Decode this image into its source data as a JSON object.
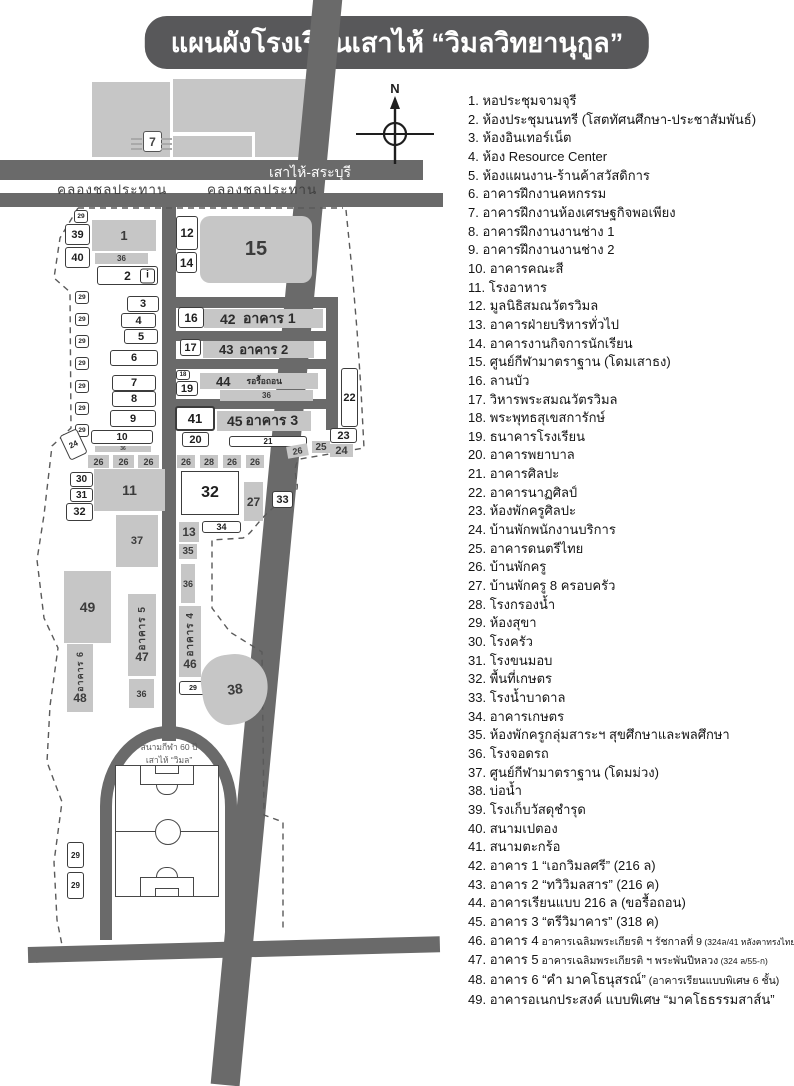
{
  "title": "แผนผังโรงเรียนเสาไห้ “วิมลวิทยานุกูล”",
  "compass": {
    "north_label": "N"
  },
  "roads": {
    "main_road": "เสาไห้-สระบุรี",
    "canal_left": "คลองชลประทาน",
    "canal_right": "คลองชลประทาน"
  },
  "stadium": {
    "line1": "สนามกีฬา 60 ปี",
    "line2": "เสาไห้ “วิมล”"
  },
  "icons": {
    "seven_store": "7",
    "info": "i"
  },
  "map_labels": {
    "n1": "1",
    "n2": "2",
    "n3": "3",
    "n4": "4",
    "n5": "5",
    "n6": "6",
    "n7": "7",
    "n8": "8",
    "n9": "9",
    "n10": "10",
    "n11": "11",
    "n12": "12",
    "n13": "13",
    "n14": "14",
    "n15": "15",
    "n16": "16",
    "n17": "17",
    "n18": "18",
    "n19": "19",
    "n20": "20",
    "n21": "21",
    "n22": "22",
    "n23": "23",
    "n24": "24",
    "n25": "25",
    "n26": "26",
    "n27": "27",
    "n28": "28",
    "n29": "29",
    "n30": "30",
    "n31": "31",
    "n32": "32",
    "n33": "33",
    "n34": "34",
    "n35": "35",
    "n36": "36",
    "n37": "37",
    "n38": "38",
    "n39": "39",
    "n40": "40",
    "n41": "41",
    "n42": "42",
    "n43": "43",
    "n44": "44",
    "n45": "45",
    "n46": "46",
    "n47": "47",
    "n48": "48",
    "n49": "49",
    "row42_name": "อาคาร 1",
    "row43_name": "อาคาร 2",
    "row44_name": "รอรื้อถอน",
    "row45_name": "อาคาร 3",
    "v4": "อาคาร 4",
    "v5": "อาคาร 5",
    "v6": "อาคาร 6"
  },
  "legend": {
    "items": [
      {
        "n": "1.",
        "text": "หอประชุมจามจุรี"
      },
      {
        "n": "2.",
        "text": "ห้องประชุมนนทรี (โสตทัศนศึกษา-ประชาสัมพันธ์)"
      },
      {
        "n": "3.",
        "text": "ห้องอินเทอร์เน็ต"
      },
      {
        "n": "4.",
        "text": "ห้อง Resource Center"
      },
      {
        "n": "5.",
        "text": "ห้องแผนงาน-ร้านค้าสวัสดิการ"
      },
      {
        "n": "6.",
        "text": "อาคารฝึกงานคหกรรม"
      },
      {
        "n": "7.",
        "text": "อาคารฝึกงานห้องเศรษฐกิจพอเพียง"
      },
      {
        "n": "8.",
        "text": "อาคารฝึกงานงานช่าง 1"
      },
      {
        "n": "9.",
        "text": "อาคารฝึกงานงานช่าง 2"
      },
      {
        "n": "10.",
        "text": "อาคารคณะสี"
      },
      {
        "n": "11.",
        "text": "โรงอาหาร"
      },
      {
        "n": "12.",
        "text": "มูลนิธิสมณวัตรวิมล"
      },
      {
        "n": "13.",
        "text": "อาคารฝ่ายบริหารทั่วไป"
      },
      {
        "n": "14.",
        "text": "อาคารงานกิจการนักเรียน"
      },
      {
        "n": "15.",
        "text": "ศูนย์กีฬามาตราฐาน (โดมเสาธง)"
      },
      {
        "n": "16.",
        "text": "ลานบัว"
      },
      {
        "n": "17.",
        "text": "วิหารพระสมณวัตรวิมล"
      },
      {
        "n": "18.",
        "text": "พระพุทธสุเขสการักษ์"
      },
      {
        "n": "19.",
        "text": "ธนาคารโรงเรียน"
      },
      {
        "n": "20.",
        "text": "อาคารพยาบาล"
      },
      {
        "n": "21.",
        "text": "อาคารศิลปะ"
      },
      {
        "n": "22.",
        "text": "อาคารนาฏศิลป์"
      },
      {
        "n": "23.",
        "text": "ห้องพักครูศิลปะ"
      },
      {
        "n": "24.",
        "text": "บ้านพักพนักงานบริการ"
      },
      {
        "n": "25.",
        "text": "อาคารดนตรีไทย"
      },
      {
        "n": "26.",
        "text": "บ้านพักครู"
      },
      {
        "n": "27.",
        "text": "บ้านพักครู 8 ครอบครัว"
      },
      {
        "n": "28.",
        "text": "โรงกรองน้ำ"
      },
      {
        "n": "29.",
        "text": "ห้องสุขา"
      },
      {
        "n": "30.",
        "text": "โรงครัว"
      },
      {
        "n": "31.",
        "text": "โรงขนมอบ"
      },
      {
        "n": "32.",
        "text": "พื้นที่เกษตร"
      },
      {
        "n": "33.",
        "text": "โรงน้ำบาดาล"
      },
      {
        "n": "34.",
        "text": "อาคารเกษตร"
      },
      {
        "n": "35.",
        "text": "ห้องพักครูกลุ่มสาระฯ สุขศึกษาและพลศึกษา"
      },
      {
        "n": "36.",
        "text": "โรงจอดรถ"
      },
      {
        "n": "37.",
        "text": "ศูนย์กีฬามาตราฐาน (โดมม่วง)"
      },
      {
        "n": "38.",
        "text": "บ่อน้ำ"
      },
      {
        "n": "39.",
        "text": "โรงเก็บวัสดุชำรุด"
      },
      {
        "n": "40.",
        "text": "สนามเปตอง"
      },
      {
        "n": "41.",
        "text": "สนามตะกร้อ"
      },
      {
        "n": "42.",
        "text": "อาคาร 1 “เอกวิมลศรี” (216 ล)"
      },
      {
        "n": "43.",
        "text": "อาคาร 2 “ทวิวิมลสาร” (216 ค)"
      },
      {
        "n": "44.",
        "text": "อาคารเรียนแบบ 216 ล (ขอรื้อถอน)"
      },
      {
        "n": "45.",
        "text": "อาคาร 3 “ตรีวิมาคาร” (318 ค)"
      },
      {
        "n": "46.",
        "text": "อาคาร 4",
        "mid": "อาคารเฉลิมพระเกียรติ ฯ รัชกาลที่ 9",
        "small": "(324ล/41 หลังคาทรงไทย)"
      },
      {
        "n": "47.",
        "text": "อาคาร 5",
        "mid": "อาคารเฉลิมพระเกียรติ ฯ พระพันปีหลวง",
        "small": "(324 ล/55-ก)"
      },
      {
        "n": "48.",
        "text": "อาคาร 6 “คำ มาคโธนุสรณ์”",
        "mid": "(อาคารเรียนแบบพิเศษ 6 ชั้น)"
      },
      {
        "n": "49.",
        "text": "อาคารอเนกประสงค์ แบบพิเศษ “มาคโธธรรมสาส์น”"
      }
    ]
  }
}
